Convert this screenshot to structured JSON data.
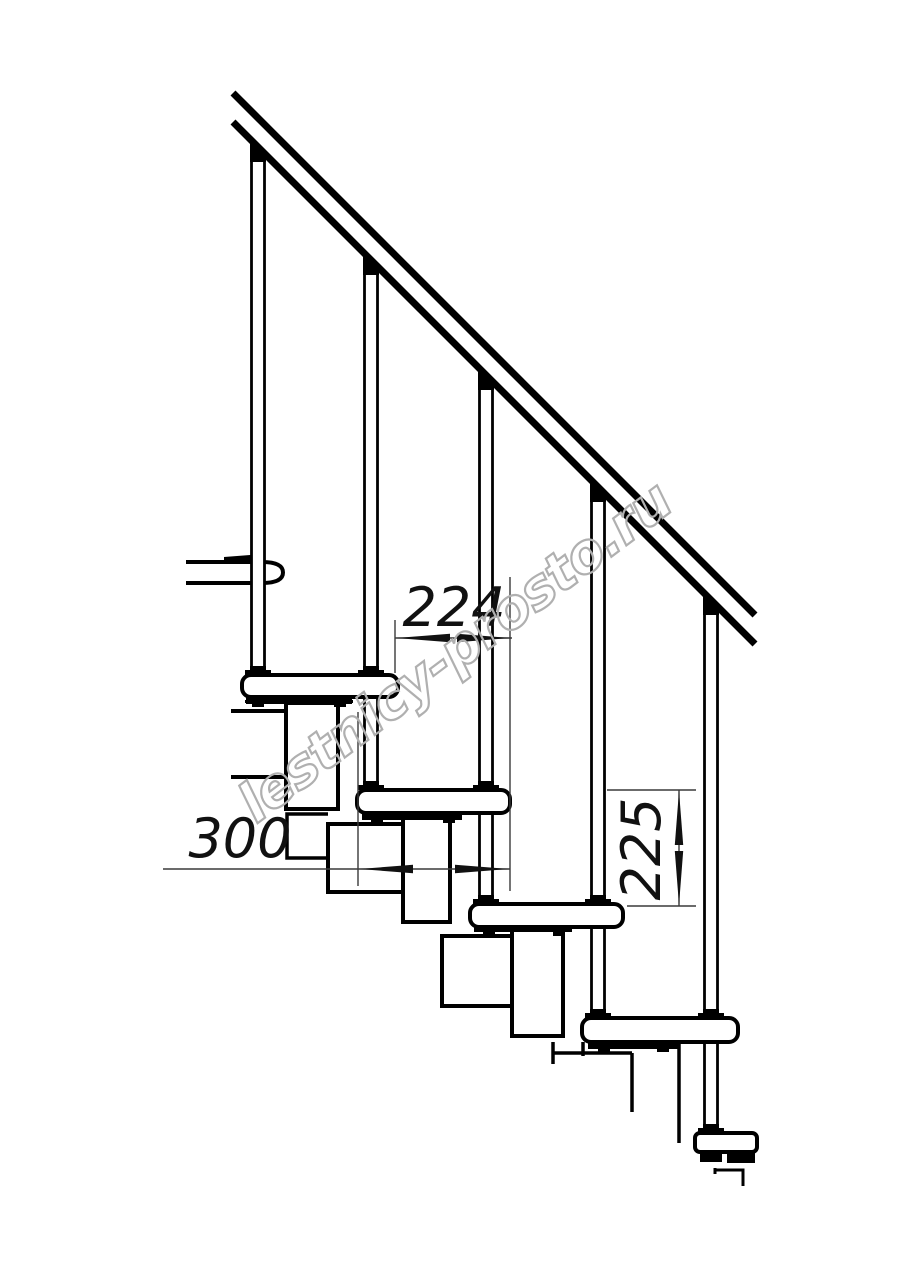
{
  "drawing": {
    "subject": "Modular staircase side elevation technical drawing",
    "background": "#ffffff",
    "ink": "#000000",
    "dim_line_color": "#3a3a3a",
    "dimensions": {
      "pitch": {
        "label": "224",
        "orientation": "horizontal"
      },
      "depth": {
        "label": "300",
        "orientation": "horizontal"
      },
      "rise": {
        "label": "225",
        "orientation": "vertical"
      }
    },
    "watermark": {
      "text": "lestnicy-prosto.ru",
      "color": "#b0b0b0"
    }
  }
}
